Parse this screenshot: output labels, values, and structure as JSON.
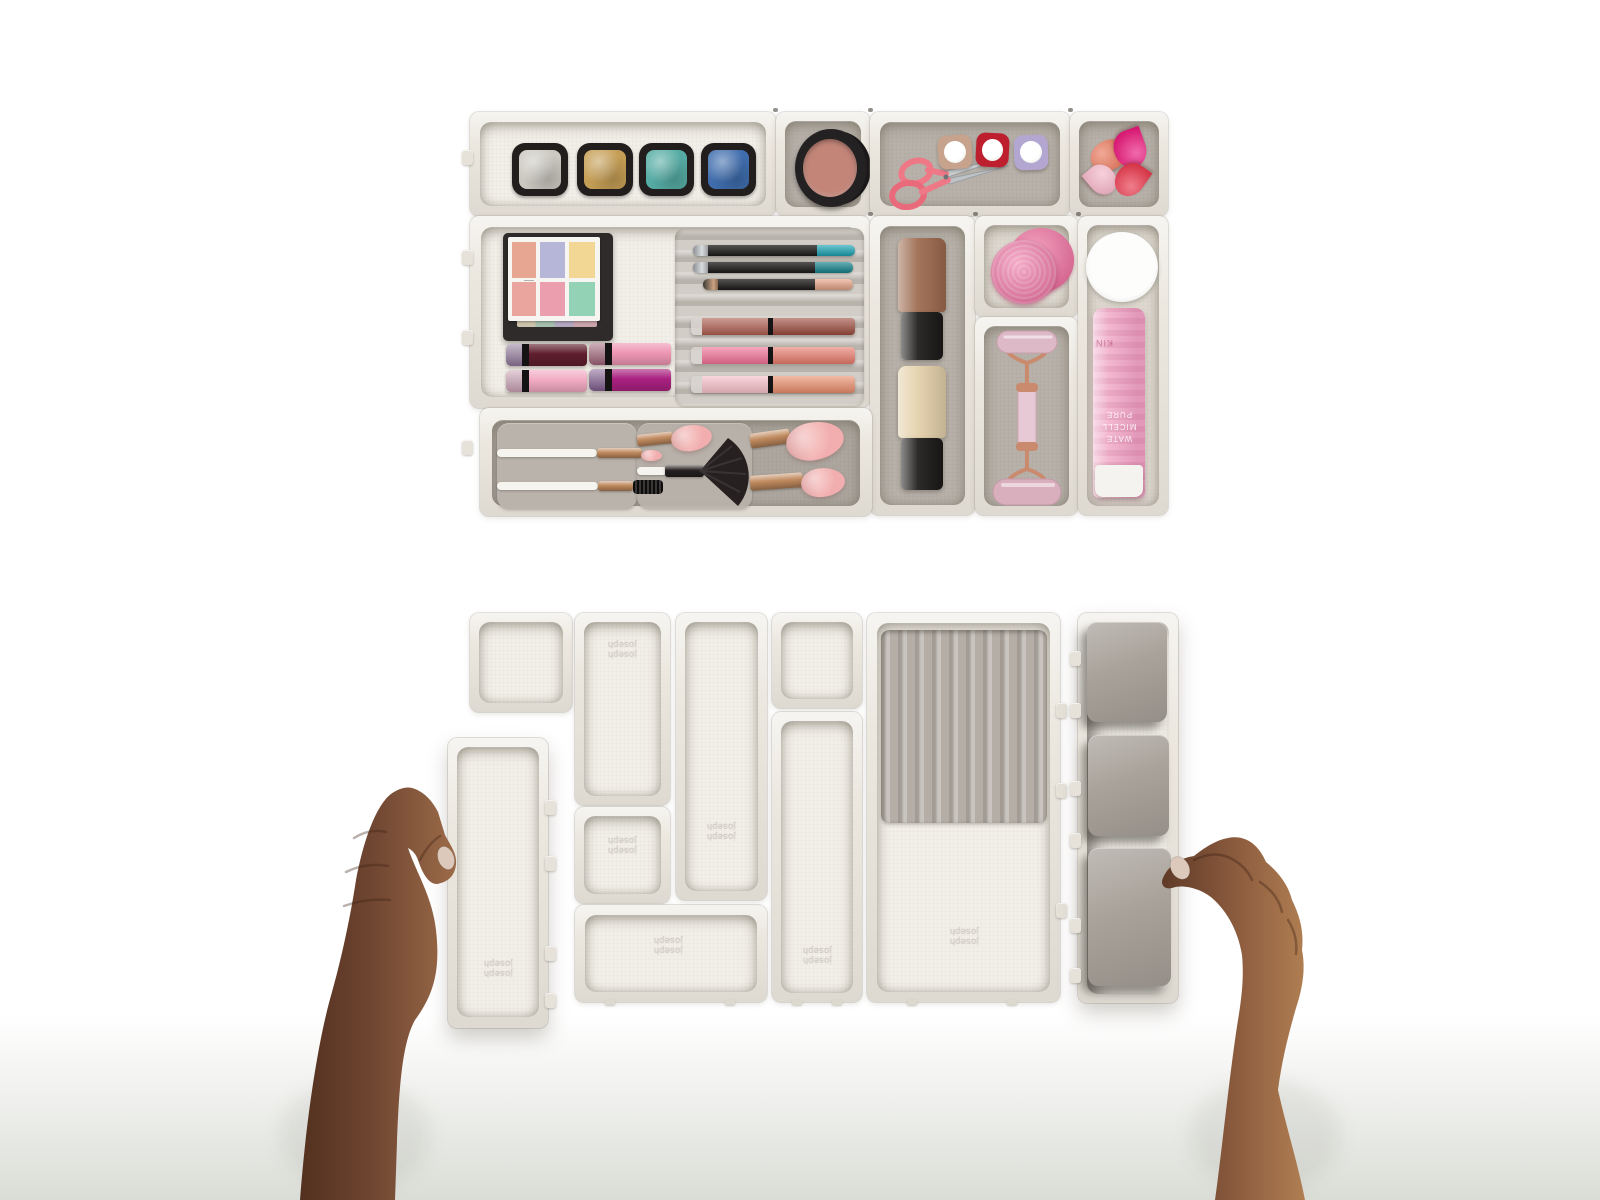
{
  "branding": {
    "embossed_logo": "joseph joseph"
  },
  "bottle_label": {
    "line1": "PURE",
    "line2": "MICELL",
    "line3": "WATE",
    "side": "KIN"
  },
  "colors": {
    "shell": "#ece8e0",
    "floor_white": "#f2efe8",
    "floor_gray": "#b7b1a9",
    "floor_soft": "#ded9d0",
    "insert_ridged": "#c8c3bb",
    "insert_ridged_dark": "#b4aea6",
    "flap_gray": "#a8a29a",
    "liner_gray": "#aca69e",
    "panel_gray": "#b9b3ab",
    "pan_frame": "#211e1d",
    "eyeshadows": [
      "#cbc8c0",
      "#c59e55",
      "#55aca4",
      "#3f6dad"
    ],
    "blush_case": "#242122",
    "blush_powder": "#c28578",
    "scissors_pink": "#ef7887",
    "blade_silver": "#cdd0d2",
    "nail_polishes": [
      "#c7a28c",
      "#bd1f2e",
      "#b3a7d2"
    ],
    "teardrop_sponges": [
      "#e97a5f",
      "#e91a7c",
      "#f4b8ca",
      "#e83a4e"
    ],
    "palette_case": "#2e2b2a",
    "palette_face": "#f7f5f1",
    "palette_swatches": [
      [
        "#e7a691",
        "#b5b6d8",
        "#f2d794"
      ],
      [
        "#eba59f",
        "#eb9fae",
        "#93d2b4"
      ]
    ],
    "lipstick_bodies": [
      [
        "#5f1e2d",
        "#ee96b4"
      ],
      [
        "#f2abc3",
        "#aa2180"
      ]
    ],
    "lipstick_tips": [
      [
        "#8d7396",
        "#9c6075"
      ],
      [
        "#c9a0b2",
        "#7e5a8c"
      ]
    ],
    "pencil_body": "#1c1a19",
    "pencil_ends": [
      "#1ba7b8",
      "#15858e",
      "#eba88a"
    ],
    "gloss_halves": [
      [
        "#aa5a4c",
        "#9c4a3c"
      ],
      [
        "#ee6d93",
        "#e87a6b"
      ],
      [
        "#f3bcc4",
        "#ea8d6b"
      ]
    ],
    "foundation_caps": [
      "#9c6a4e",
      "#e4d0aa"
    ],
    "foundation_body": "#1b1918",
    "round_sponge": "#ec6f9d",
    "roller_metal": "#c98a6e",
    "roller_quartz": "#ddb9c7",
    "mirror_white": "#fdfdfc",
    "bottle_pink": "#f0aac6",
    "bottle_cap": "#f4f3ef",
    "brush_handle": "#f6f4ef",
    "ferrule_rosegold": "#c08a5e",
    "bristle_pink": "#f2aeae",
    "bristle_dark": "#262020",
    "skin_left_base": "#6e4531",
    "skin_left_dark": "#53301f",
    "skin_left_light": "#9c6b48",
    "skin_right_base": "#8a5a3d",
    "skin_right_dark": "#5f3a27",
    "skin_right_light": "#b07e52",
    "nail_color": "#dcc9bb",
    "surface": "#e2e4df"
  }
}
